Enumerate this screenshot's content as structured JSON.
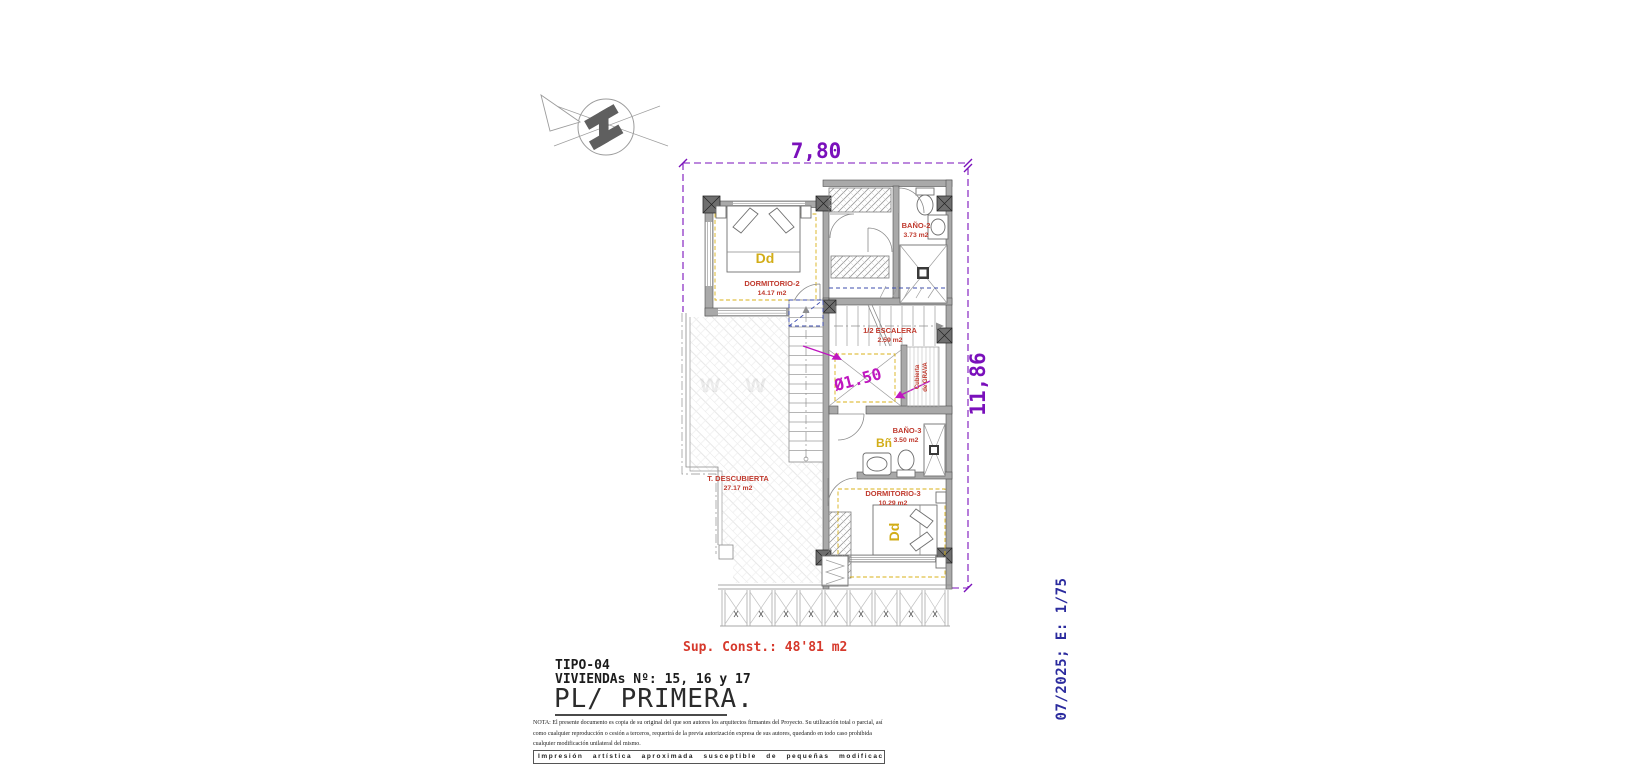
{
  "drawing": {
    "dim_width": "7,80",
    "dim_height": "11,86",
    "shaft_note": "Ø1.50",
    "watermark": "w w w",
    "gravel_line1": "Cubierta",
    "gravel_line2": "de GRAVA",
    "rooms": {
      "dormitorio2": {
        "name": "DORMITORIO-2",
        "area": "14.17 m2",
        "tag": "Dd"
      },
      "bano2": {
        "name": "BAÑO-2",
        "area": "3.73 m2"
      },
      "escalera": {
        "name": "1/2 ESCALERA",
        "area": "2.59 m2"
      },
      "bano3": {
        "name": "BAÑO-3",
        "area": "3.50 m2",
        "tag": "Bñ"
      },
      "dormitorio3": {
        "name": "DORMITORIO-3",
        "area": "10.29 m2",
        "tag": "Dd"
      },
      "terraza": {
        "name": "T. DESCUBIERTA",
        "area": "27.17 m2"
      }
    }
  },
  "title_block": {
    "sup_const": "Sup. Const.: 48'81 m2",
    "tipo": "TIPO-04",
    "viviendas": "VIVIENDAs Nº: 15, 16 y 17",
    "plan_title": "PL/ PRIMERA.",
    "nota_lines": [
      "NOTA: El presente documento es copia de su original del que son autores los arquitectos firmantes del Proyecto. Su utilización total o parcial, así",
      "como cualquier reproducción o cesión a terceros, requerirá  de la previa autorización expresa de sus autores, quedando en todo caso prohibida",
      "cualquier modificación unilateral del mismo."
    ],
    "disclaimer": "Impresión artística aproximada susceptible de pequeñas modificaciones.",
    "date_scale": "07/2025; E: 1/75"
  },
  "colors": {
    "dimension_purple": "#7a10bb",
    "diameter_magenta": "#bf16bf",
    "room_label_red": "#c03a2e",
    "sup_const_red": "#d6392c",
    "tag_gold": "#d2ad18",
    "date_navy": "#2b2b9e",
    "wall_gray": "#a9a9a9",
    "stair_blue": "#3c4cae"
  }
}
